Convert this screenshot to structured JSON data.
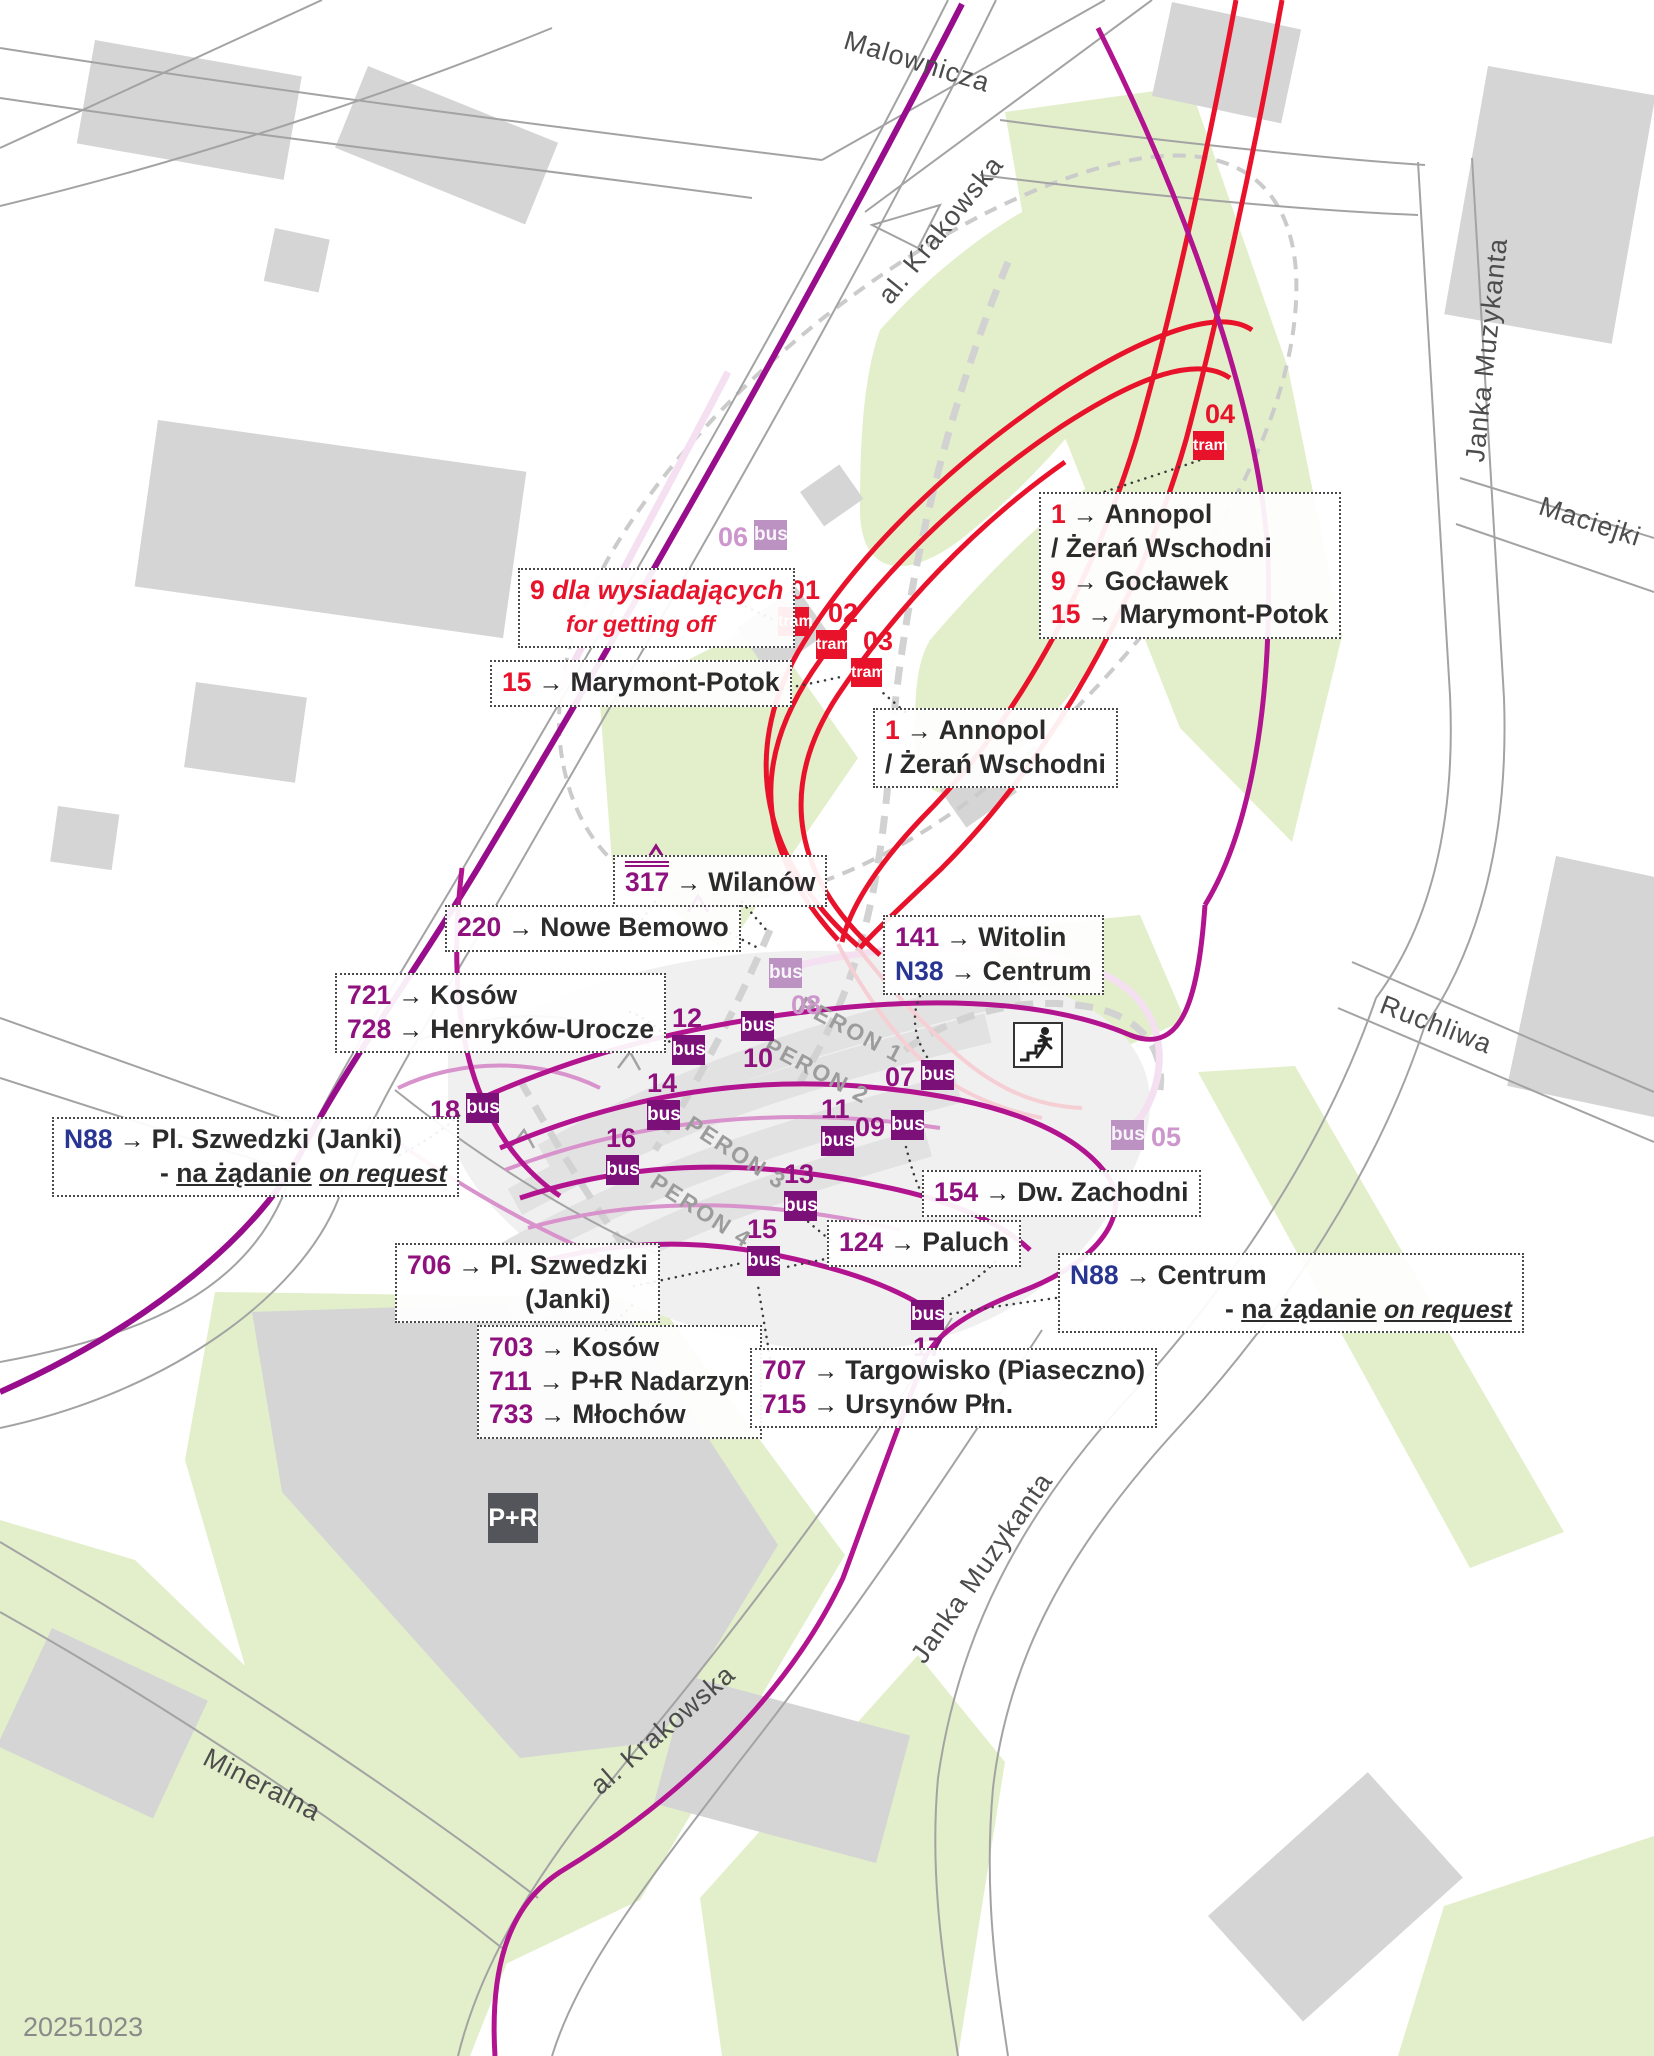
{
  "map": {
    "date_label": "20251023",
    "pr_label": "P+R",
    "badge_text": {
      "tram": "tram",
      "bus": "bus"
    },
    "colors": {
      "tram_red": "#E8132B",
      "bus_stop_purple": "#7B1078",
      "bus_number_purple": "#8E117E",
      "route_magenta": "#B2138E",
      "avenue_purple": "#970D8C",
      "night_line_navy": "#283593",
      "faded_stop_purple": "#BB92C2",
      "green_area": "#E2EFCA",
      "building_gray": "#D5D5D6"
    },
    "streets": [
      {
        "t": "Malownicza",
        "x": 917,
        "y": 62,
        "r": 17
      },
      {
        "t": "al. Krakowska",
        "x": 941,
        "y": 230,
        "r": -51
      },
      {
        "t": "Janka Muzykanta",
        "x": 1487,
        "y": 350,
        "r": -84
      },
      {
        "t": "Maciejki",
        "x": 1590,
        "y": 522,
        "r": 18
      },
      {
        "t": "Ruchliwa",
        "x": 1436,
        "y": 1025,
        "r": 21
      },
      {
        "t": "Janka Muzykanta",
        "x": 982,
        "y": 1568,
        "r": -55
      },
      {
        "t": "al. Krakowska",
        "x": 663,
        "y": 1730,
        "r": -41
      },
      {
        "t": "Mineralna",
        "x": 262,
        "y": 1785,
        "r": 27
      }
    ],
    "perons": [
      {
        "t": "PERON 1",
        "x": 851,
        "y": 1030,
        "r": 28
      },
      {
        "t": "PERON 2",
        "x": 817,
        "y": 1071,
        "r": 28
      },
      {
        "t": "PERON 3",
        "x": 736,
        "y": 1153,
        "r": 33
      },
      {
        "t": "PERON 4",
        "x": 701,
        "y": 1211,
        "r": 33
      }
    ],
    "stops": [
      {
        "id": "01",
        "kind": "tram",
        "x": 778,
        "y": 607,
        "np": "abover"
      },
      {
        "id": "02",
        "kind": "tram",
        "x": 816,
        "y": 630,
        "np": "abover"
      },
      {
        "id": "03",
        "kind": "tram",
        "x": 851,
        "y": 658,
        "np": "abover"
      },
      {
        "id": "04",
        "kind": "tram",
        "x": 1193,
        "y": 431,
        "np": "abover"
      },
      {
        "id": "05",
        "kind": "faded",
        "x": 1111,
        "y": 1120,
        "np": "right"
      },
      {
        "id": "06",
        "kind": "faded",
        "x": 754,
        "y": 520,
        "np": "left"
      },
      {
        "id": "07",
        "kind": "bus",
        "x": 921,
        "y": 1060,
        "np": "left"
      },
      {
        "id": "08",
        "kind": "faded",
        "x": 769,
        "y": 958,
        "np": "belowr"
      },
      {
        "id": "09",
        "kind": "bus",
        "x": 891,
        "y": 1110,
        "np": "left"
      },
      {
        "id": "10",
        "kind": "bus",
        "x": 741,
        "y": 1011,
        "np": "below"
      },
      {
        "id": "11",
        "kind": "bus",
        "x": 821,
        "y": 1126,
        "np": "above"
      },
      {
        "id": "12",
        "kind": "bus",
        "x": 672,
        "y": 1035,
        "np": "above"
      },
      {
        "id": "13",
        "kind": "bus",
        "x": 784,
        "y": 1191,
        "np": "above"
      },
      {
        "id": "14",
        "kind": "bus",
        "x": 647,
        "y": 1100,
        "np": "above"
      },
      {
        "id": "15",
        "kind": "bus",
        "x": 747,
        "y": 1246,
        "np": "above"
      },
      {
        "id": "16",
        "kind": "bus",
        "x": 606,
        "y": 1155,
        "np": "above"
      },
      {
        "id": "17",
        "kind": "bus",
        "x": 911,
        "y": 1300,
        "np": "below"
      },
      {
        "id": "18",
        "kind": "bus",
        "x": 466,
        "y": 1093,
        "np": "left"
      }
    ],
    "labels": [
      {
        "id": "tram-terminus-group",
        "x": 1039,
        "y": 492,
        "lines": [
          {
            "ind": 0,
            "sp": [
              {
                "t": "1",
                "c": "red"
              },
              {
                "t": "→",
                "c": "arrow"
              },
              {
                "t": "Annopol",
                "c": "dest"
              }
            ]
          },
          {
            "ind": 0,
            "sp": [
              {
                "t": "/ Żerań Wschodni",
                "c": "dest"
              }
            ]
          },
          {
            "ind": 0,
            "sp": [
              {
                "t": "9",
                "c": "red"
              },
              {
                "t": "→",
                "c": "arrow"
              },
              {
                "t": "Gocławek",
                "c": "dest"
              }
            ]
          },
          {
            "ind": 0,
            "sp": [
              {
                "t": "15",
                "c": "red"
              },
              {
                "t": "→",
                "c": "arrow"
              },
              {
                "t": "Marymont-Potok",
                "c": "dest"
              }
            ]
          }
        ]
      },
      {
        "id": "note-getting-off",
        "x": 518,
        "y": 568,
        "lines": [
          {
            "ind": 0,
            "sp": [
              {
                "t": "9",
                "c": "red"
              },
              {
                "t": " dla wysiadających",
                "c": "itred"
              }
            ]
          },
          {
            "ind": 36,
            "sp": [
              {
                "t": "for getting off",
                "c": "itredsm"
              }
            ]
          }
        ]
      },
      {
        "id": "dest-15-marymont",
        "x": 490,
        "y": 660,
        "lines": [
          {
            "ind": 0,
            "sp": [
              {
                "t": "15",
                "c": "red"
              },
              {
                "t": "→",
                "c": "arrow"
              },
              {
                "t": "Marymont-Potok",
                "c": "dest"
              }
            ]
          }
        ]
      },
      {
        "id": "dest-1-annopol",
        "x": 873,
        "y": 708,
        "lines": [
          {
            "ind": 0,
            "sp": [
              {
                "t": "1",
                "c": "red"
              },
              {
                "t": "→",
                "c": "arrow"
              },
              {
                "t": "Annopol",
                "c": "dest"
              }
            ]
          },
          {
            "ind": 0,
            "sp": [
              {
                "t": "/ Żerań Wschodni",
                "c": "dest"
              }
            ]
          }
        ]
      },
      {
        "id": "dest-317-wilanow",
        "x": 613,
        "y": 855,
        "lines": [
          {
            "ind": 0,
            "sp": [
              {
                "t": "317",
                "c": "po"
              },
              {
                "t": "→",
                "c": "arrow"
              },
              {
                "t": "Wilanów",
                "c": "dest"
              }
            ]
          }
        ]
      },
      {
        "id": "dest-220-bemowo",
        "x": 445,
        "y": 905,
        "lines": [
          {
            "ind": 0,
            "sp": [
              {
                "t": "220",
                "c": "pur"
              },
              {
                "t": "→",
                "c": "arrow"
              },
              {
                "t": "Nowe Bemowo",
                "c": "dest"
              }
            ]
          }
        ]
      },
      {
        "id": "dest-141-n38",
        "x": 883,
        "y": 915,
        "lines": [
          {
            "ind": 0,
            "sp": [
              {
                "t": "141",
                "c": "pur"
              },
              {
                "t": "→",
                "c": "arrow"
              },
              {
                "t": "Witolin",
                "c": "dest"
              }
            ]
          },
          {
            "ind": 0,
            "sp": [
              {
                "t": "N38",
                "c": "navy"
              },
              {
                "t": "→",
                "c": "arrow"
              },
              {
                "t": "Centrum",
                "c": "dest"
              }
            ]
          }
        ]
      },
      {
        "id": "dest-721-728",
        "x": 335,
        "y": 973,
        "lines": [
          {
            "ind": 0,
            "sp": [
              {
                "t": "721",
                "c": "pur"
              },
              {
                "t": "→",
                "c": "arrow"
              },
              {
                "t": "Kosów",
                "c": "dest"
              }
            ]
          },
          {
            "ind": 0,
            "sp": [
              {
                "t": "728",
                "c": "pur"
              },
              {
                "t": "→",
                "c": "arrow"
              },
              {
                "t": "Henryków-Urocze",
                "c": "dest"
              }
            ]
          }
        ]
      },
      {
        "id": "dest-n88-janki",
        "x": 52,
        "y": 1117,
        "lines": [
          {
            "ind": 0,
            "sp": [
              {
                "t": "N88",
                "c": "navy"
              },
              {
                "t": "→",
                "c": "arrow"
              },
              {
                "t": "Pl. Szwedzki (Janki)",
                "c": "dest"
              }
            ]
          },
          {
            "ind": 96,
            "sp": [
              {
                "t": "- ",
                "c": "dest"
              },
              {
                "t": "na żądanie",
                "c": "ub"
              },
              {
                "t": " ",
                "c": "plain"
              },
              {
                "t": "on request",
                "c": "ui"
              }
            ]
          }
        ]
      },
      {
        "id": "dest-154-zachodni",
        "x": 922,
        "y": 1170,
        "lines": [
          {
            "ind": 0,
            "sp": [
              {
                "t": "154",
                "c": "pur"
              },
              {
                "t": "→",
                "c": "arrow"
              },
              {
                "t": "Dw. Zachodni",
                "c": "dest"
              }
            ]
          }
        ]
      },
      {
        "id": "dest-124-paluch",
        "x": 827,
        "y": 1220,
        "lines": [
          {
            "ind": 0,
            "sp": [
              {
                "t": "124",
                "c": "pur"
              },
              {
                "t": "→",
                "c": "arrow"
              },
              {
                "t": "Paluch",
                "c": "dest"
              }
            ]
          }
        ]
      },
      {
        "id": "dest-706-janki",
        "x": 395,
        "y": 1243,
        "lines": [
          {
            "ind": 0,
            "sp": [
              {
                "t": "706",
                "c": "pur"
              },
              {
                "t": "→",
                "c": "arrow"
              },
              {
                "t": "Pl. Szwedzki",
                "c": "dest"
              }
            ]
          },
          {
            "ind": 118,
            "sp": [
              {
                "t": "(Janki)",
                "c": "dest"
              }
            ]
          }
        ]
      },
      {
        "id": "dest-703-711-733",
        "x": 477,
        "y": 1325,
        "lines": [
          {
            "ind": 0,
            "sp": [
              {
                "t": "703",
                "c": "pur"
              },
              {
                "t": "→",
                "c": "arrow"
              },
              {
                "t": "Kosów",
                "c": "dest"
              }
            ]
          },
          {
            "ind": 0,
            "sp": [
              {
                "t": "711",
                "c": "pur"
              },
              {
                "t": "→",
                "c": "arrow"
              },
              {
                "t": "P+R Nadarzyn",
                "c": "dest"
              }
            ]
          },
          {
            "ind": 0,
            "sp": [
              {
                "t": "733",
                "c": "pur"
              },
              {
                "t": "→",
                "c": "arrow"
              },
              {
                "t": "Młochów",
                "c": "dest"
              }
            ]
          }
        ]
      },
      {
        "id": "dest-707-715",
        "x": 750,
        "y": 1348,
        "lines": [
          {
            "ind": 0,
            "sp": [
              {
                "t": "707",
                "c": "pur"
              },
              {
                "t": "→",
                "c": "arrow"
              },
              {
                "t": "Targowisko (Piaseczno)",
                "c": "dest"
              }
            ]
          },
          {
            "ind": 0,
            "sp": [
              {
                "t": "715",
                "c": "pur"
              },
              {
                "t": "→",
                "c": "arrow"
              },
              {
                "t": "Ursynów Płn.",
                "c": "dest"
              }
            ]
          }
        ]
      },
      {
        "id": "dest-n88-centrum",
        "x": 1058,
        "y": 1253,
        "lines": [
          {
            "ind": 0,
            "sp": [
              {
                "t": "N88",
                "c": "navy"
              },
              {
                "t": "→",
                "c": "arrow"
              },
              {
                "t": "Centrum",
                "c": "dest"
              }
            ]
          },
          {
            "ind": 155,
            "sp": [
              {
                "t": "- ",
                "c": "dest"
              },
              {
                "t": "na żądanie",
                "c": "ub"
              },
              {
                "t": " ",
                "c": "plain"
              },
              {
                "t": "on request",
                "c": "ui"
              }
            ]
          }
        ]
      }
    ]
  }
}
